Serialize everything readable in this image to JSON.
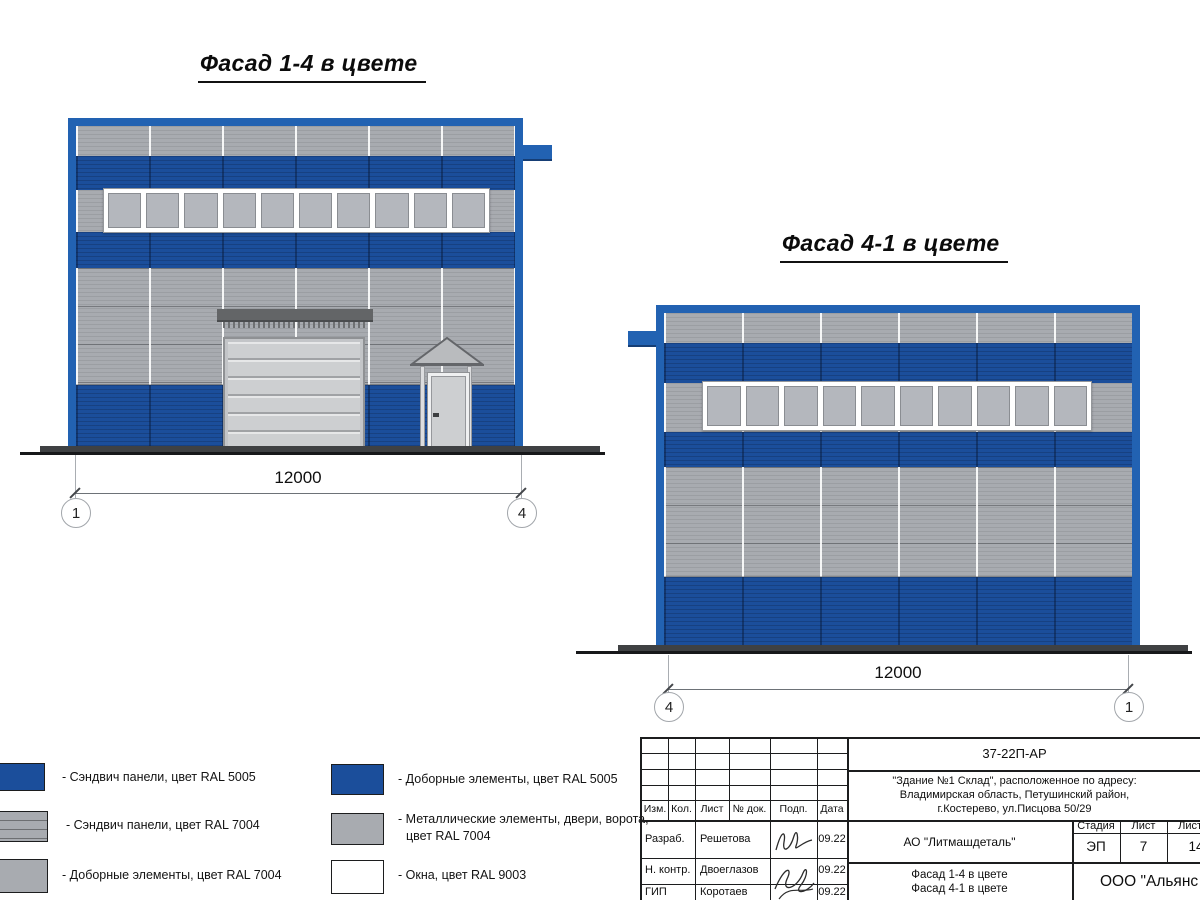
{
  "titles": {
    "facade_1_4": "Фасад 1-4 в цвете",
    "facade_4_1": "Фасад 4-1 в цвете"
  },
  "facade_1_4": {
    "dimension": "12000",
    "axis_left": "1",
    "axis_right": "4"
  },
  "facade_4_1": {
    "dimension": "12000",
    "axis_left": "4",
    "axis_right": "1"
  },
  "legend": {
    "left": [
      {
        "swatch": "sandwich-panel-ral5005",
        "label": "- Сэндвич панели, цвет RAL 5005"
      },
      {
        "swatch": "sandwich-panel-ral7004",
        "label": "- Сэндвич панели, цвет RAL 7004"
      },
      {
        "swatch": "trim-ral7004",
        "label": "- Доборные элементы, цвет RAL 7004"
      }
    ],
    "right": [
      {
        "swatch": "trim-ral5005",
        "label": "- Доборные элементы, цвет RAL 5005"
      },
      {
        "swatch": "metal-ral7004",
        "label_line1": "- Металлические элементы, двери, ворота,",
        "label_line2": "цвет RAL 7004"
      },
      {
        "swatch": "windows-ral9003",
        "label": "- Окна, цвет RAL 9003"
      }
    ]
  },
  "title_block": {
    "doc_number": "37-22П-АР",
    "address_line1": "\"Здание №1 Склад\", расположенное по адресу:",
    "address_line2": "Владимирская область, Петушинский район,",
    "address_line3": "г.Костерево, ул.Писцова 50/29",
    "col_izm": "Изм.",
    "col_kol": "Кол.",
    "col_list": "Лист",
    "col_doc": "№ док.",
    "col_podp": "Подп.",
    "col_data": "Дата",
    "rows": [
      {
        "role": "Разраб.",
        "name": "Решетова",
        "date": "09.22"
      },
      {
        "role": "Н. контр.",
        "name": "Двоеглазов",
        "date": "09.22"
      },
      {
        "role": "ГИП",
        "name": "Коротаев",
        "date": "09.22"
      }
    ],
    "client": "АО \"Литмашдеталь\"",
    "sheet_title_line1": "Фасад 1-4 в цвете",
    "sheet_title_line2": "Фасад 4-1 в цвете",
    "stage_label": "Стадия",
    "sheet_label": "Лист",
    "sheets_label": "Листов",
    "stage_value": "ЭП",
    "sheet_value": "7",
    "sheets_value": "14",
    "company": "ООО \"Альянс"
  },
  "colors": {
    "blue-frame": "#2262B2",
    "blue-panel": "#1B4E9B",
    "gray-panel": "#A8ABB0",
    "window-pane": "#B4B7BD",
    "door-gray": "#CDCFD1",
    "canopy": "#636567",
    "ground": "#3F4143",
    "white": "#FFFFFF"
  }
}
